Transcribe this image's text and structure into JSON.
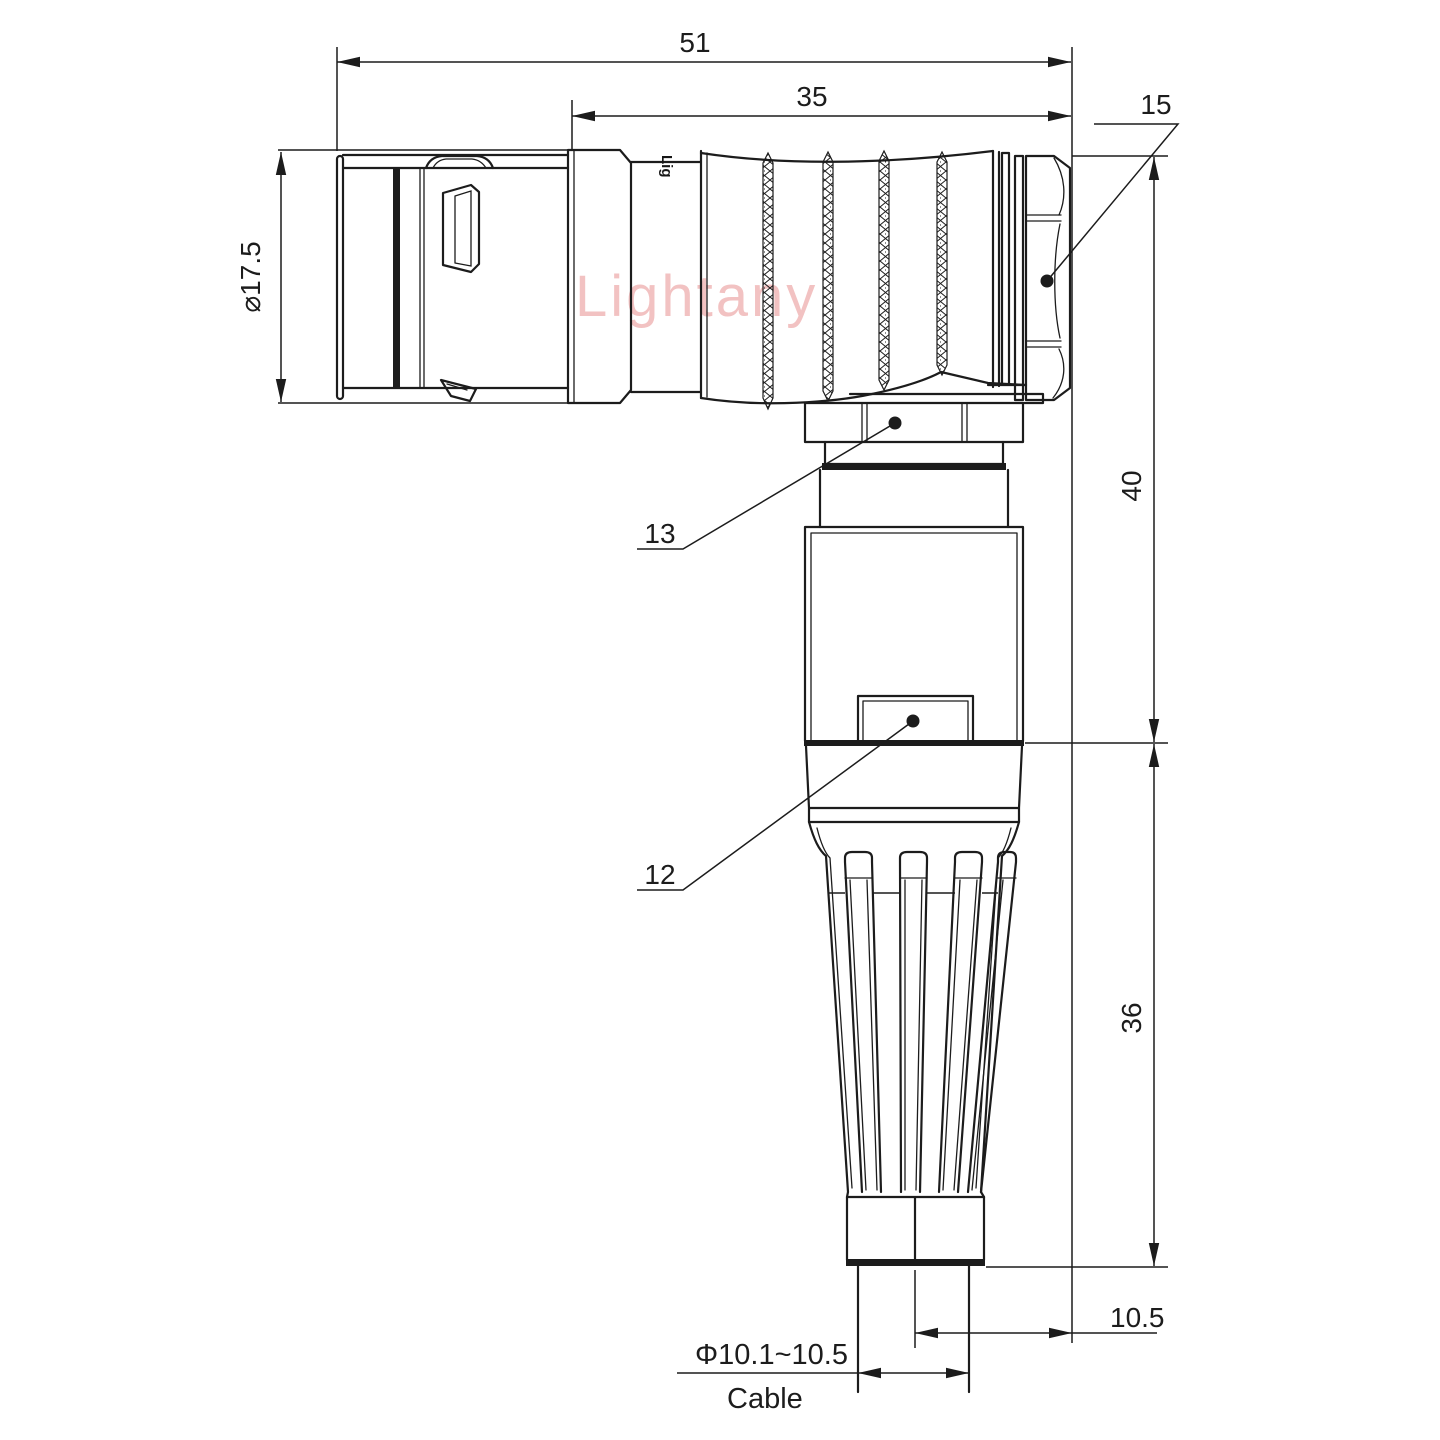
{
  "drawing": {
    "title_dims": {
      "overall_length": "51",
      "rear_section_length": "35",
      "nut_ref": "15",
      "upper_height": "40",
      "lower_height": "36",
      "axis_offset": "10.5",
      "front_diameter": "⌀17.5",
      "cable_diameter_range": "Φ10.1~10.5",
      "cable_label": "Cable",
      "gland_ref": "13",
      "housing_ref": "12"
    },
    "watermark": "Lightany",
    "body_mark": "Lig",
    "colors": {
      "line": "#1c1c1c",
      "watermark_pink": "#efb3b3",
      "background": "#ffffff"
    }
  }
}
